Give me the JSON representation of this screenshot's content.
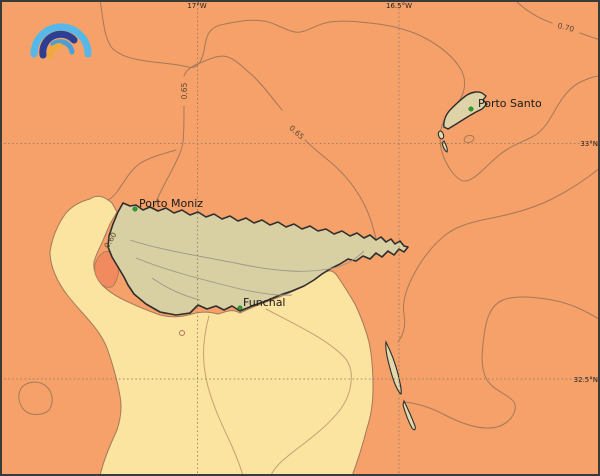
{
  "map": {
    "grid": {
      "lon_labels": {
        "w17": "17°W",
        "w165": "16.5°W"
      },
      "lat_labels": {
        "n33": "33°N",
        "n325": "32.5°N"
      }
    },
    "places": {
      "porto_santo": "Porto Santo",
      "porto_moniz": "Porto Moniz",
      "funchal": "Funchal"
    },
    "contour_labels": {
      "c070": "0.70",
      "c065_west": "0.65",
      "c065_mid": "0.65",
      "c060": "0.60"
    },
    "colors": {
      "ocean": "#f5a169",
      "shallow": "#fbe3a0",
      "land_madeira": "#d8cfa2",
      "land_porto_santo": "#ddd3a6",
      "land_desertas": "#e2d9ac",
      "patch": "#f18b5f",
      "contour": "#a5795a",
      "contour_shallow": "#c5a075",
      "island_contour": "#98988a",
      "coastline": "#2e2e2e",
      "marker": "#2ca02c",
      "label": "#1a1a1a",
      "contour_label": "#5a4632",
      "grid": "#8a7a68",
      "frame": "#3a3a3a",
      "logo_outer": "#56b8e8",
      "logo_navy": "#2c3f93",
      "logo_mid": "#4a9fd8",
      "logo_yellow": "#f2a93b"
    }
  }
}
